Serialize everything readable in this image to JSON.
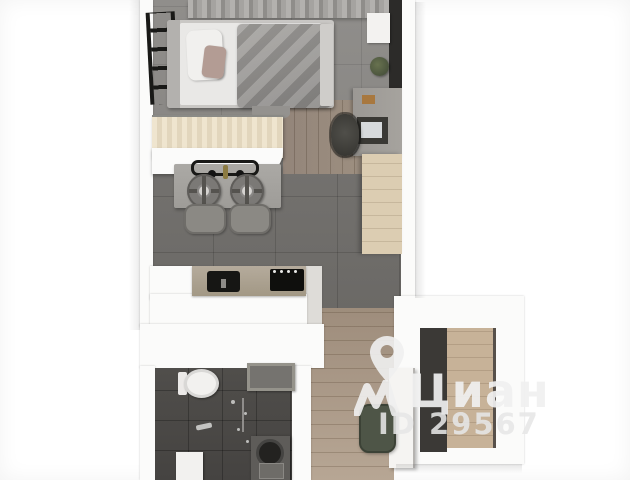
{
  "meta": {
    "title": "Studio apartment — top-down 3D floor plan render",
    "type": "3d-floor-plan"
  },
  "watermark": {
    "brand": "Циан",
    "listing_id": "ID 29567",
    "pin_icon": "location-pin-icon",
    "logo_icon": "cian-roof-logo-icon",
    "color": "#f0f0f0"
  },
  "palette": {
    "wall": "#fbfbfa",
    "wallShade": "#dedcd8",
    "tileBedroom": "#8d8b88",
    "tileLiving": "#706e6b",
    "tileBath": "#4b4947",
    "woodHall": "#ab9a89",
    "woodWalkway": "#968879",
    "woodBar": "#e9dec8",
    "woodWardrobe": "#dccdb2",
    "woodEntry": "#c7b298",
    "darkPanel": "#2c2b29",
    "whiteFixture": "#f3f2f0",
    "poufGreen": "#4e5547",
    "appliance": "#141412"
  },
  "plan": {
    "rooms": [
      "sleeping-area",
      "kitchen-living-area",
      "bathroom",
      "entry-hall",
      "wardrobe-niche"
    ],
    "furniture": [
      "curtains",
      "wall-ladder-shelf",
      "double-bed",
      "pillows",
      "blanket",
      "tv-panel",
      "wall-shelf",
      "plant",
      "desk",
      "monitor",
      "office-chair",
      "wardrobe",
      "breakfast-bar",
      "island-cooktop",
      "gas-burners",
      "bar-stools",
      "kitchen-counter",
      "sink",
      "cooktop",
      "wall-hung-toilet",
      "bath-niche",
      "shower-fittings",
      "washing-machine",
      "bath-mat",
      "entry-cabinet",
      "pouf",
      "entry-wardrobe"
    ]
  }
}
